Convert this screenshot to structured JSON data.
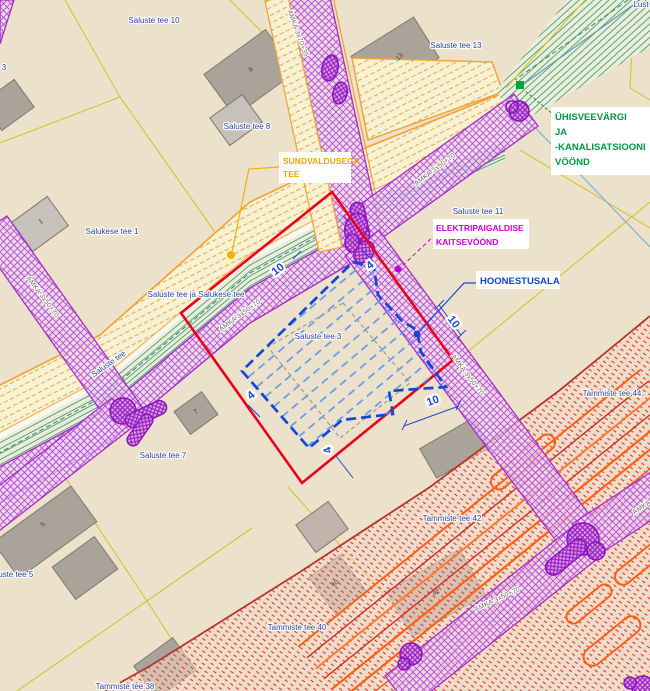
{
  "map": {
    "annotation_labels": {
      "sundvaldus": {
        "line1": "SUNDVALDUSEGA",
        "line2": "TEE"
      },
      "uvk": {
        "line1": "ÜHISVEEVÄRGI",
        "line2": "JA",
        "line3": "-KANALISATSIOONI",
        "line4": "VÖÖND"
      },
      "elektri": {
        "line1": "ELEKTRIPAIGALDISE",
        "line2": "KAITSEVÖÖND"
      },
      "hoonestusala": "HOONESTUSALA"
    },
    "parcel_labels": [
      {
        "text": "Saluste tee 10",
        "x": 154,
        "y": 23,
        "rot": 0
      },
      {
        "text": "Saluste tee 13",
        "x": 456,
        "y": 48,
        "rot": 0
      },
      {
        "text": "Saluste tee 8",
        "x": 247,
        "y": 129,
        "rot": 0
      },
      {
        "text": "Salukese tee 1",
        "x": 112,
        "y": 234,
        "rot": 0
      },
      {
        "text": "Saluste tee ja Salukese tee",
        "x": 196,
        "y": 297,
        "rot": 0
      },
      {
        "text": "Saluste tee",
        "x": 110,
        "y": 366,
        "rot": -35
      },
      {
        "text": "Saluste tee 11",
        "x": 478,
        "y": 214,
        "rot": 0
      },
      {
        "text": "Saluste tee 7",
        "x": 163,
        "y": 458,
        "rot": 0
      },
      {
        "text": "Saluste tee 5",
        "x": 10,
        "y": 577,
        "rot": 0
      },
      {
        "text": "Saluste tee 3",
        "x": 318,
        "y": 339,
        "rot": 0
      },
      {
        "text": "Tammiste tee 44",
        "x": 612,
        "y": 396,
        "rot": 0
      },
      {
        "text": "Tammiste tee 42",
        "x": 452,
        "y": 521,
        "rot": 0
      },
      {
        "text": "Tammiste tee 40",
        "x": 297,
        "y": 630,
        "rot": 0
      },
      {
        "text": "Tammiste tee 38",
        "x": 125,
        "y": 689,
        "rot": 0
      },
      {
        "text": "Lust",
        "x": 641,
        "y": 7,
        "rot": 0
      },
      {
        "text": "3",
        "x": 4,
        "y": 70,
        "rot": 0
      }
    ],
    "cable_labels": [
      {
        "text": "AMKA 3x70+35",
        "x": 296,
        "y": 34,
        "rot": 70
      },
      {
        "text": "AMKA 3x50+70",
        "x": 436,
        "y": 171,
        "rot": -37
      },
      {
        "text": "AMKA 3x50+70",
        "x": 241,
        "y": 317,
        "rot": -36
      },
      {
        "text": "AMKA 3x50+70",
        "x": 41,
        "y": 298,
        "rot": 53
      },
      {
        "text": "AMKA 3x50+70",
        "x": 466,
        "y": 376,
        "rot": 53
      },
      {
        "text": "AMKA 3x50+70",
        "x": 498,
        "y": 601,
        "rot": -25
      },
      {
        "text": "AMKA 3x50+70",
        "x": 655,
        "y": 501,
        "rot": -33
      }
    ],
    "dimension_labels": [
      {
        "text": "10",
        "x": 280,
        "y": 272,
        "rot": -38
      },
      {
        "text": "10",
        "x": 451,
        "y": 324,
        "rot": 52
      },
      {
        "text": "10",
        "x": 434,
        "y": 404,
        "rot": -20
      },
      {
        "text": "4",
        "x": 372,
        "y": 268,
        "rot": -38
      },
      {
        "text": "4",
        "x": 253,
        "y": 398,
        "rot": -38
      },
      {
        "text": "4",
        "x": 331,
        "y": 449,
        "rot": -110
      }
    ],
    "building_numbers": [
      {
        "text": "8",
        "x": 252,
        "y": 71,
        "rot": -36
      },
      {
        "text": "13",
        "x": 401,
        "y": 58,
        "rot": -50
      },
      {
        "text": "1",
        "x": 42,
        "y": 223,
        "rot": -36
      },
      {
        "text": "7",
        "x": 197,
        "y": 413,
        "rot": -36
      },
      {
        "text": "5",
        "x": 44,
        "y": 526,
        "rot": -36
      },
      {
        "text": "40",
        "x": 336,
        "y": 585,
        "rot": -36
      },
      {
        "text": "42",
        "x": 437,
        "y": 594,
        "rot": -30
      }
    ],
    "colors": {
      "background": "#ece1cb",
      "cadastral_line": "#d2c62e",
      "road_border_orange": "#f0a43c",
      "water_sewer_green": "#55a187",
      "electric_purple": "#a82cc8",
      "red_zone": "#cf3f2a",
      "plot_boundary_red": "#ea0019",
      "hoonestusala_blue": "#1447d8",
      "parcel_label_blue": "#2b3fa0"
    }
  }
}
